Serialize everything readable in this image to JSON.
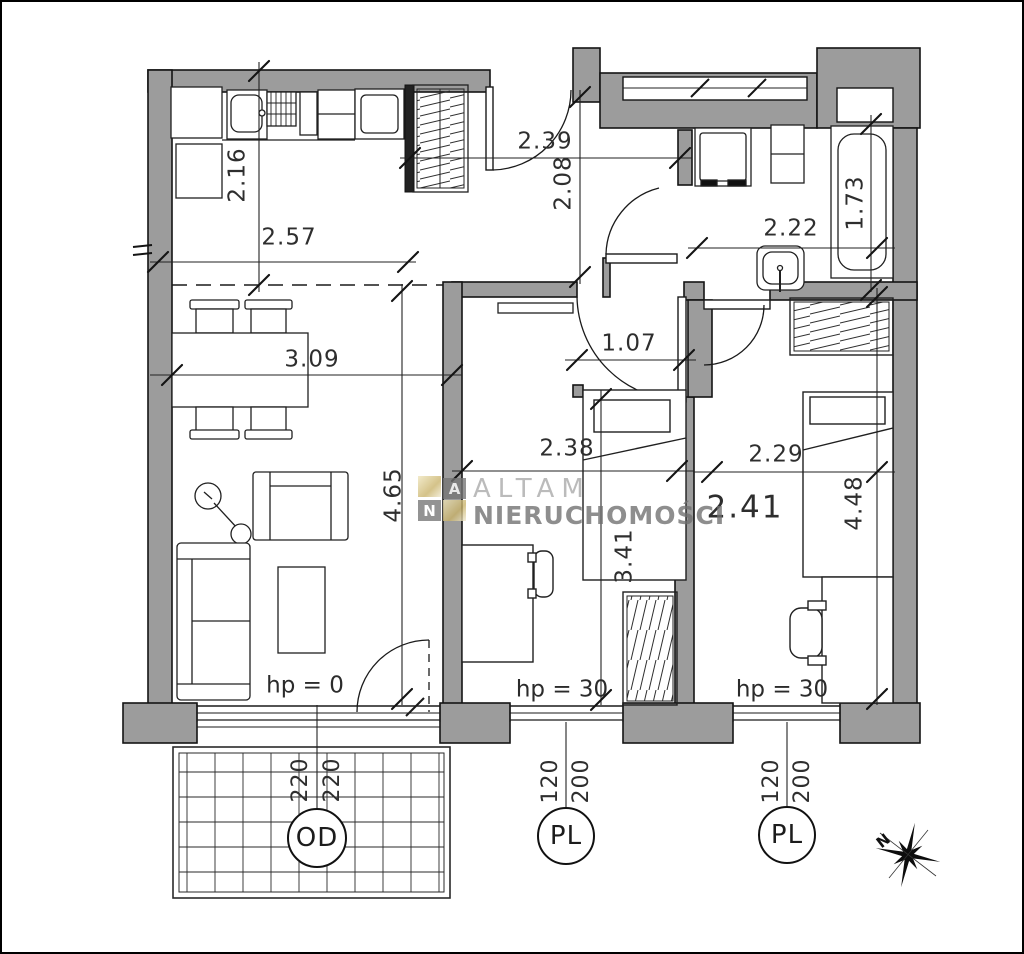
{
  "plan": {
    "dims": {
      "kitchen_w": "2.57",
      "kitchen_h": "2.16",
      "hall_w": "2.39",
      "hall_h": "2.08",
      "bath_w": "2.22",
      "bath_h": "1.73",
      "living_w": "3.09",
      "living_h": "4.65",
      "mid_door": "1.07",
      "mid_w": "2.38",
      "mid_h": "3.41",
      "right_w": "2.29",
      "right_big": "2.41",
      "right_h": "4.48"
    },
    "levels": {
      "living": "hp = 0",
      "mid": "hp = 30",
      "right": "hp = 30"
    },
    "openings": {
      "balcony_door": {
        "tag": "OD",
        "w": "220",
        "h": "220"
      },
      "window_mid": {
        "tag": "PL",
        "w": "120",
        "h": "200"
      },
      "window_right": {
        "tag": "PL",
        "w": "120",
        "h": "200"
      }
    },
    "watermark": {
      "line1": "ALTAM",
      "line2": "NIERUCHOMOŚCI",
      "logo_a": "A",
      "logo_n": "N",
      "gold": "#c9b269",
      "gray": "#6f6f6f"
    },
    "compass": {
      "north": "N"
    },
    "colors": {
      "wall_fill": "#9c9c9c",
      "line": "#1c1c1c"
    }
  }
}
